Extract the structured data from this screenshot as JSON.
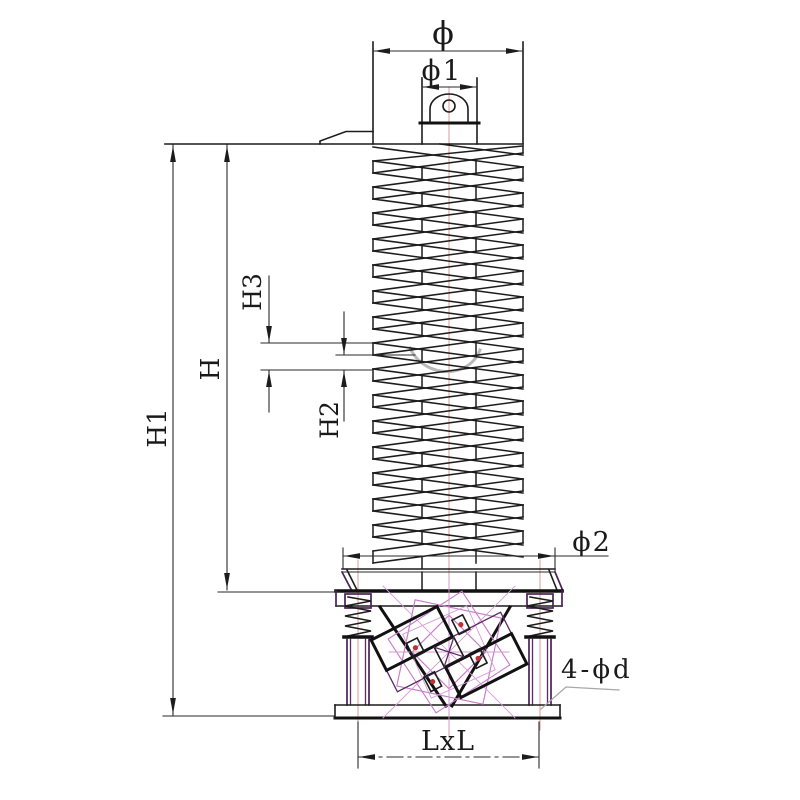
{
  "title": "Vertical vibrating spiral elevator - dimensional outline drawing",
  "labels": {
    "top_diameter": "ϕ",
    "lug_diameter": "ϕ1",
    "base_diameter": "ϕ2",
    "overall_height": "H1",
    "spiral_height": "H",
    "flight_gap": "H2",
    "flight_pitch": "H3",
    "anchor_holes": "4-ϕd",
    "base_footprint": "LxL"
  },
  "colors": {
    "line": "#1c1c1c",
    "centerline": "#dc9a9a",
    "phantom_magenta": "#c87bc8",
    "structure_purple": "#4a2156",
    "logo_salmon": "#ef8181",
    "logo_gray": "#b9b9b9"
  },
  "drawing": {
    "spiral_turns": 16,
    "pitch_px": 26,
    "spiral_left_x": 373,
    "spiral_right_x": 523,
    "shaft_left_x": 422,
    "shaft_right_x": 476,
    "top_flange_y": 144,
    "pan_rim_y": 569,
    "table_top_y": 591,
    "base_plate_top_y": 705,
    "base_plate_bottom_y": 718,
    "center_x": 449,
    "leg_centers_x": [
      358,
      540
    ]
  }
}
